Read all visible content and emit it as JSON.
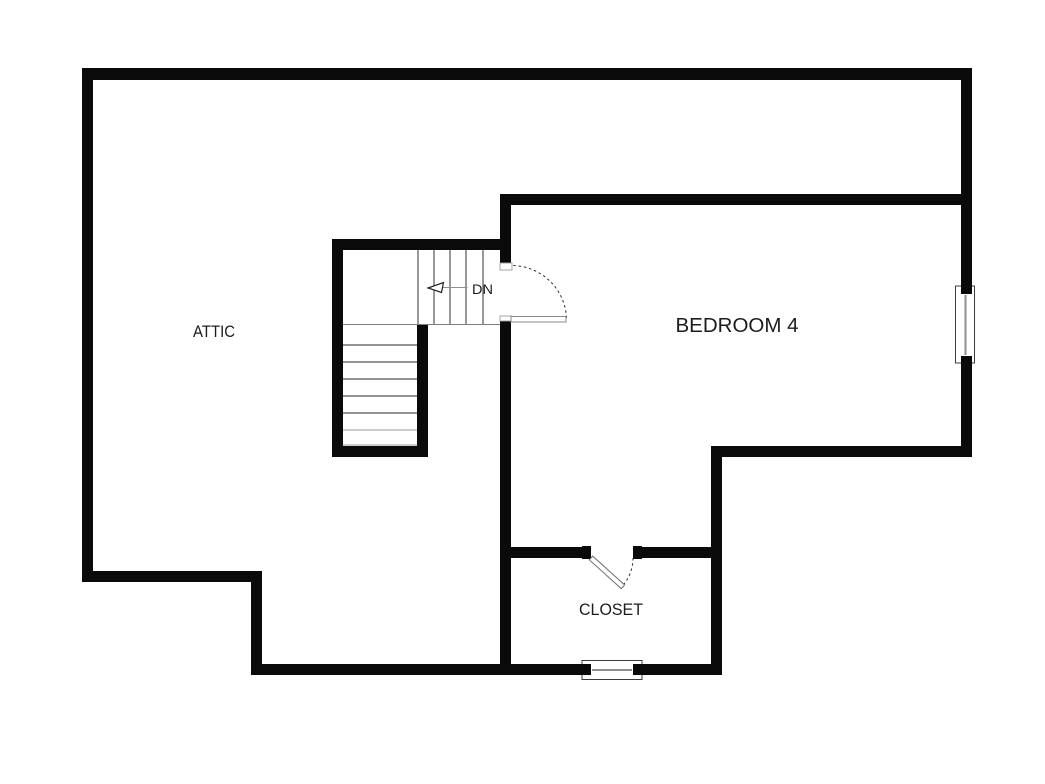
{
  "colors": {
    "background": "#ffffff",
    "wall": "#0a0a0a",
    "stair-tread": "#555555",
    "door-swing": "#2f2f2f",
    "window-mullion": "#8f8f8f",
    "window-frame": "#3d3d3d",
    "label-text": "#1c1c1c"
  },
  "rooms": {
    "attic": {
      "label": "ATTIC"
    },
    "bedroom4": {
      "label": "BEDROOM 4"
    },
    "closet": {
      "label": "CLOSET"
    }
  },
  "stairs": {
    "direction_label": "DN",
    "direction_icon": "arrow-left-icon",
    "shape": "l-shaped",
    "upper_run_tread_count": 5,
    "lower_run_tread_count": 7
  },
  "features": {
    "doors": [
      {
        "name": "bedroom-door",
        "style": "single-swing"
      },
      {
        "name": "closet-door",
        "style": "single-swing"
      }
    ],
    "windows": [
      {
        "name": "bedroom-window",
        "location": "right-exterior-wall"
      },
      {
        "name": "closet-window",
        "location": "bottom-exterior-wall"
      }
    ]
  }
}
